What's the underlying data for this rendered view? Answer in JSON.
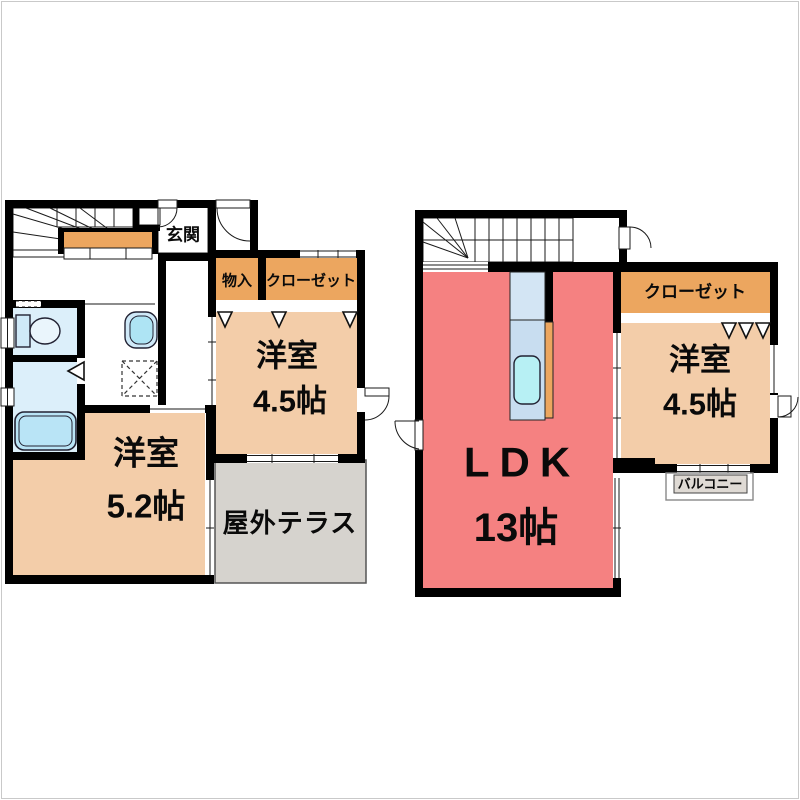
{
  "plan": {
    "floor1": {
      "entrance_label": "玄関",
      "storage_label": "物入",
      "closet_label": "クローゼット",
      "room1_name": "洋室",
      "room1_size": "4.5帖",
      "room2_name": "洋室",
      "room2_size": "5.2帖",
      "terrace_label": "屋外テラス"
    },
    "floor2": {
      "ldk_name": "LDK",
      "ldk_size": "13帖",
      "closet_label": "クローゼット",
      "room_name": "洋室",
      "room_size": "4.5帖",
      "balcony_label": "バルコニー"
    }
  },
  "colors": {
    "wall": "#000000",
    "stairs_orange": "#ECA65F",
    "closet_orange": "#ECA65F",
    "room_peach": "#F3CDA9",
    "ldk_pink": "#F58181",
    "entry_gray": "#D9D9D9",
    "terrace_gray": "#D6D3CE",
    "balcony_gray": "#DFDAD4",
    "water_blue": "#DCEFFA",
    "tub_blue": "#B9E4F6",
    "sink_blue": "#CFE9F8",
    "sink_inner_cyan": "#AEE4F4",
    "counter_blue_top": "#D3E5F4",
    "counter_blue": "#C8DDF0",
    "kitchen_sink_cyan": "#B7F0F4"
  }
}
